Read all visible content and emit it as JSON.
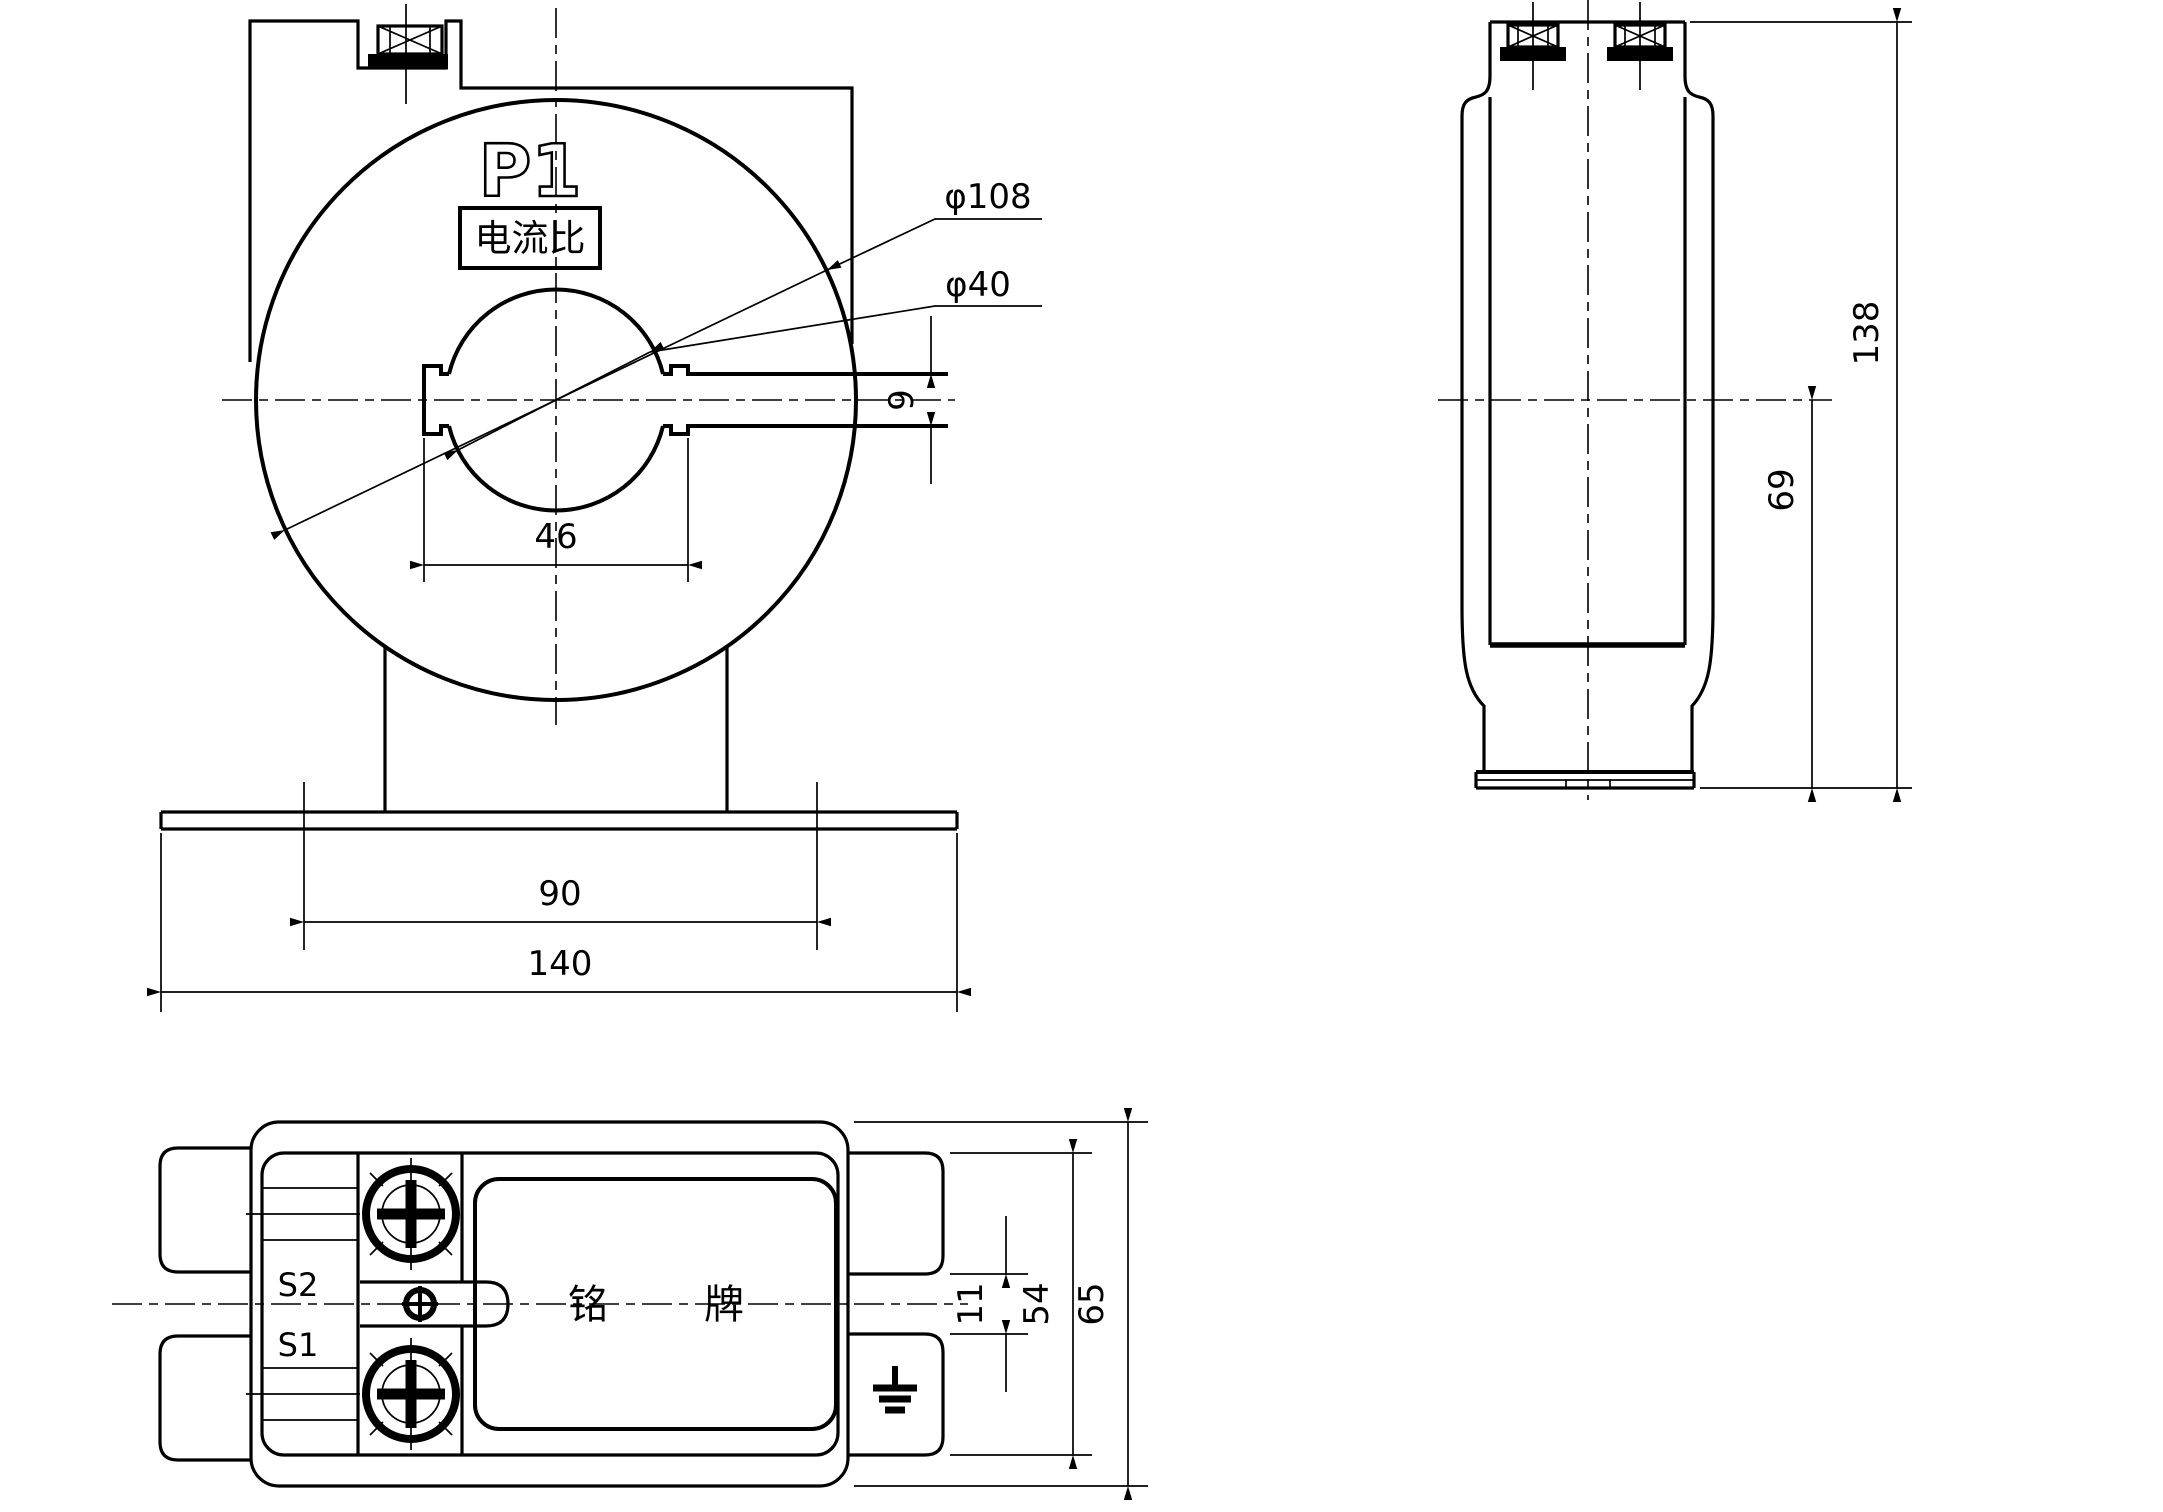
{
  "front_view": {
    "p1_label": "P1",
    "ratio_box_label": "电流比",
    "dims": {
      "outer_dia": "φ108",
      "hole_dia": "φ40",
      "slot_height": "9",
      "slot_width": "46",
      "mount_span": "90",
      "base_width": "140"
    }
  },
  "side_view": {
    "dims": {
      "overall_height": "138",
      "half_height": "69"
    }
  },
  "bottom_view": {
    "terminals": {
      "s2": "S2",
      "s1": "S1"
    },
    "nameplate_label": "铭牌",
    "dims": {
      "tab_gap": "11",
      "inner_width": "54",
      "overall_width": "65"
    }
  },
  "colors": {
    "line": "#000000",
    "background": "#ffffff"
  }
}
